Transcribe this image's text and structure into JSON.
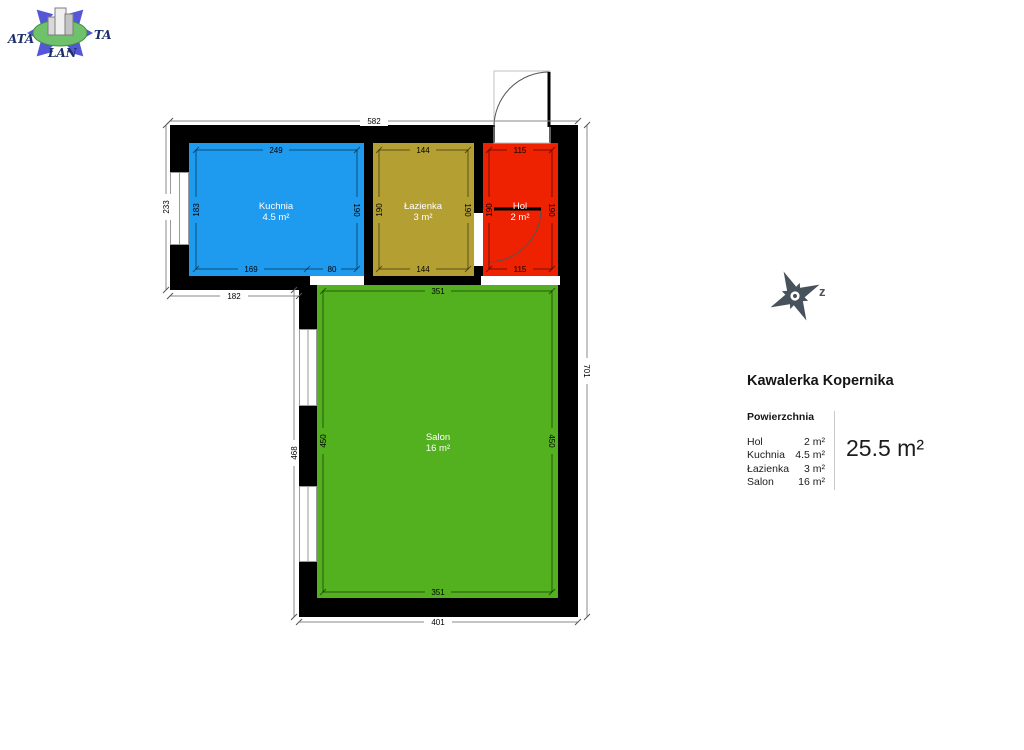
{
  "logo": {
    "text_left": "ATA",
    "text_right": "TA",
    "text_bottom": "LAN",
    "arrow_color": "#5557d8",
    "ellipse_color": "#6fc26b"
  },
  "compass": {
    "direction_label": "z",
    "color": "#47525c"
  },
  "title": "Kawalerka Kopernika",
  "legend": {
    "header": "Powierzchnia",
    "rows": [
      {
        "label": "Hol",
        "value": "2 m²"
      },
      {
        "label": "Kuchnia",
        "value": "4.5 m²"
      },
      {
        "label": "Łazienka",
        "value": "3 m²"
      },
      {
        "label": "Salon",
        "value": "16 m²"
      }
    ],
    "total": "25.5 m²"
  },
  "rooms": [
    {
      "name": "Kuchnia",
      "area": "4.5 m²",
      "color": "#1e9aef"
    },
    {
      "name": "Łazienka",
      "area": "3 m²",
      "color": "#b49f33"
    },
    {
      "name": "Hol",
      "area": "2 m²",
      "color": "#ee2101"
    },
    {
      "name": "Salon",
      "area": "16 m²",
      "color": "#53b01f"
    }
  ],
  "dimensions": {
    "outer": {
      "top": "582",
      "left_upper": "233",
      "left_lower": "468",
      "right": "701",
      "bottom_left": "182",
      "bottom": "401"
    },
    "kuchnia": {
      "top": "249",
      "left": "183",
      "right": "190",
      "bottom_left": "169",
      "bottom_right": "80"
    },
    "lazienka": {
      "top": "144",
      "left": "190",
      "right": "190",
      "bottom": "144"
    },
    "hol": {
      "top": "115",
      "left": "190",
      "right": "190",
      "bottom": "115"
    },
    "salon": {
      "top": "351",
      "left": "450",
      "right": "450",
      "bottom": "351"
    }
  },
  "wall_color": "#000000"
}
